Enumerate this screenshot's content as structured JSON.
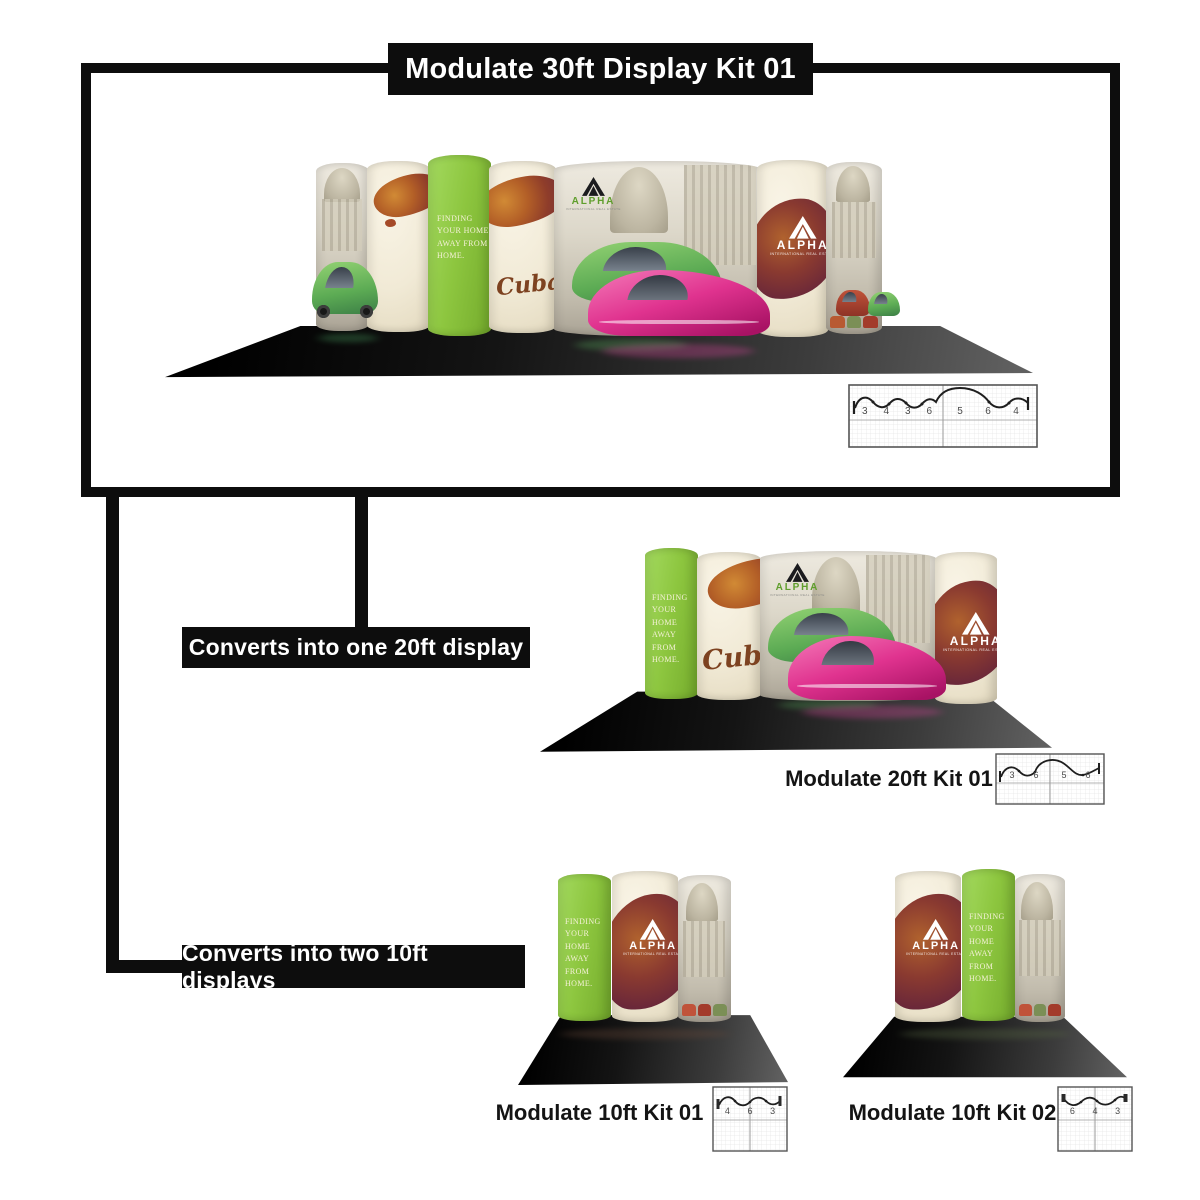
{
  "header": {
    "title": "Modulate 30ft Display Kit 01"
  },
  "branches": {
    "b20": {
      "label": "Converts into one 20ft display"
    },
    "b10": {
      "label": "Converts into two 10ft displays"
    }
  },
  "kits": {
    "k30": {
      "schematic_numbers": [
        "3",
        "4",
        "3",
        "6",
        "5",
        "6",
        "4"
      ]
    },
    "k20": {
      "name": "Modulate 20ft Kit 01",
      "schematic_numbers": [
        "3",
        "6",
        "5",
        "6"
      ]
    },
    "k10a": {
      "name": "Modulate 10ft Kit 01",
      "schematic_numbers": [
        "4",
        "6",
        "3"
      ]
    },
    "k10b": {
      "name": "Modulate 10ft Kit 02",
      "schematic_numbers": [
        "6",
        "4",
        "3"
      ]
    }
  },
  "booth_graphics": {
    "tagline_lines": [
      "FINDING",
      "YOUR HOME",
      "AWAY FROM",
      "HOME."
    ],
    "brand": "ALPHA",
    "brand_sub": "INTERNATIONAL REAL ESTATE",
    "script_word": "Cuba"
  },
  "palette": {
    "black": "#0d0d0d",
    "green": "#8dc63f",
    "cream": "#f1ead6",
    "maroon": "#6b2839",
    "pink": "#e0338f",
    "car_green": "#5cab54"
  }
}
